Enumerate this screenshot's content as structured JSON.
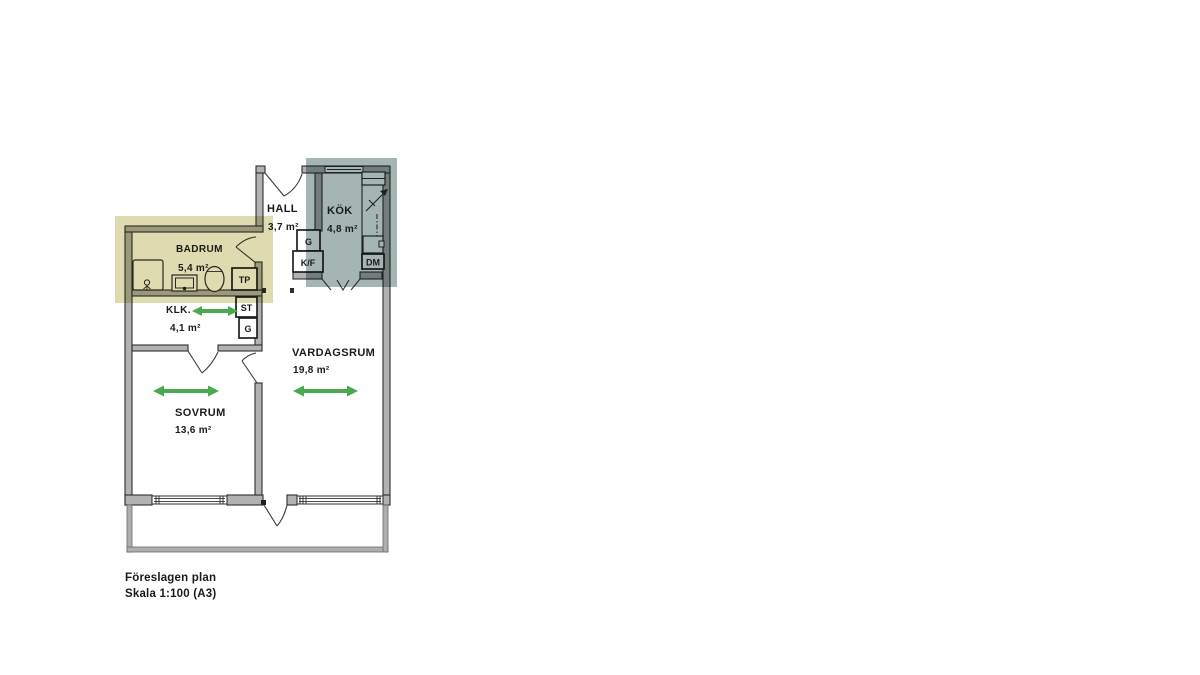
{
  "caption": {
    "line1": "Föreslagen plan",
    "line2": "Skala 1:100 (A3)"
  },
  "rooms": [
    {
      "id": "badrum",
      "name": "BADRUM",
      "area": "5,4 m²"
    },
    {
      "id": "hall",
      "name": "HALL",
      "area": "3,7 m²"
    },
    {
      "id": "kok",
      "name": "KÖK",
      "area": "4,8 m²"
    },
    {
      "id": "klk",
      "name": "KLK.",
      "area": "4,1 m²"
    },
    {
      "id": "vardagsrum",
      "name": "VARDAGSRUM",
      "area": "19,8 m²"
    },
    {
      "id": "sovrum",
      "name": "SOVRUM",
      "area": "13,6 m²"
    }
  ],
  "fixtures": {
    "tp": "TP",
    "st": "ST",
    "g_klk": "G",
    "g_hall": "G",
    "kf": "K/F",
    "dm": "DM"
  },
  "highlights": [
    {
      "id": "badrum-highlight",
      "color": "#dedbb0"
    },
    {
      "id": "kok-highlight",
      "color": "#a4b5b2"
    }
  ],
  "colors": {
    "highlight_yellow": "#dedbb0",
    "highlight_bluegray": "#a4b5b2",
    "arrow_green": "#4aa84e",
    "wall_gray": "#b2b2b2",
    "balcony_gray": "#aeaeae",
    "line_dark": "#2e2e2e",
    "background": "#ffffff"
  },
  "icons": [
    "turning-space-arrow-icon",
    "shower-icon",
    "floor-drain-icon",
    "washbasin-icon",
    "toilet-icon",
    "stove-arrow-icon",
    "sink-icon",
    "door-swing-icon",
    "window-icon"
  ]
}
